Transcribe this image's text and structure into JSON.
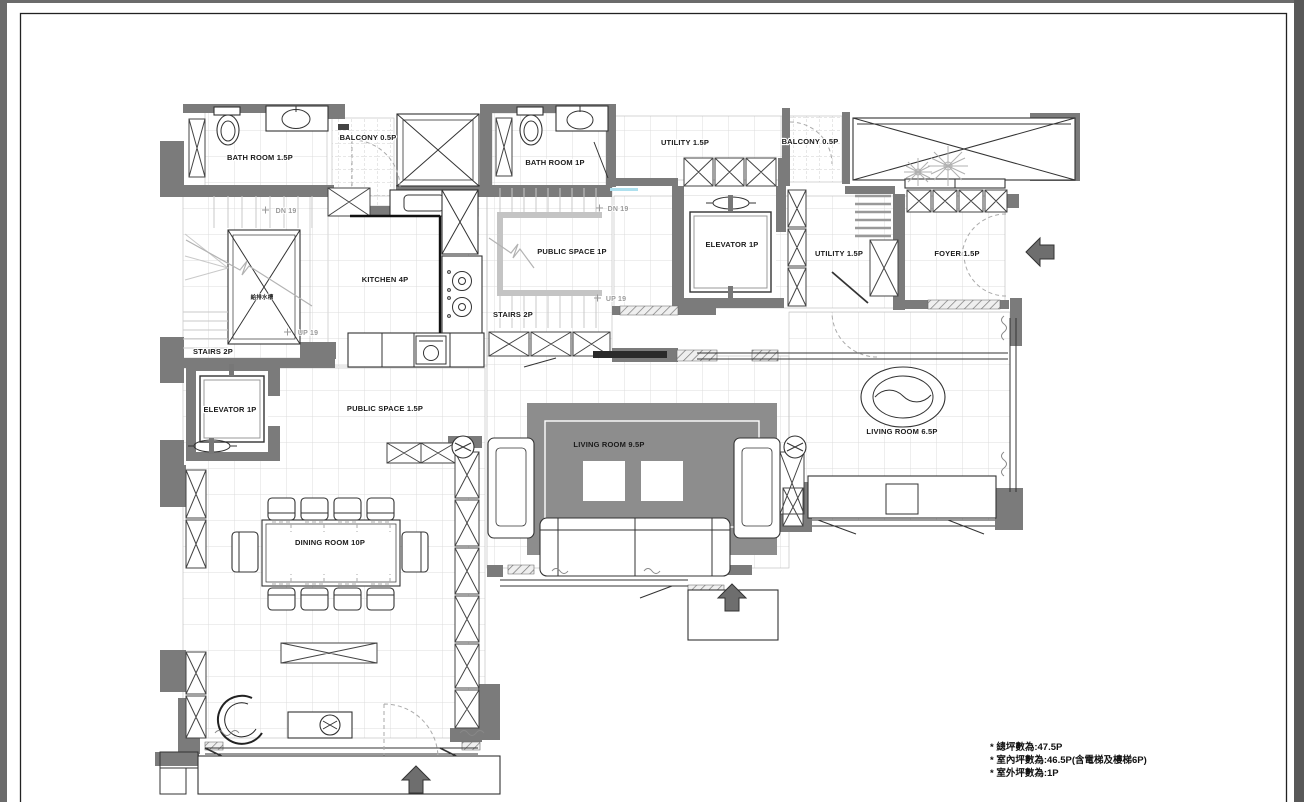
{
  "colors": {
    "wall_gray": "#7b7b7b",
    "grid_line": "#dcdcdc",
    "rug_gray": "#8d8d8d",
    "ink": "#1a1a1a",
    "muted_gray": "#9a9a9a",
    "accent_blue": "#aee0ee"
  },
  "floor_plan": {
    "rooms": {
      "bath1": "BATH ROOM 1.5P",
      "balcony1": "BALCONY 0.5P",
      "bath2": "BATH ROOM 1P",
      "utility1": "UTILITY 1.5P",
      "balcony2": "BALCONY 0.5P",
      "kitchen": "KITCHEN 4P",
      "public1": "PUBLIC SPACE 1P",
      "stairs_center": "STAIRS 2P",
      "elevator_right": "ELEVATOR 1P",
      "utility2": "UTILITY 1.5P",
      "foyer": "FOYER 1.5P",
      "stairs_left": "STAIRS 2P",
      "elevator_left": "ELEVATOR 1P",
      "public2": "PUBLIC SPACE 1.5P",
      "living_main": "LIVING ROOM 9.5P",
      "living_side": "LIVING ROOM 6.5P",
      "dining": "DINING ROOM 10P",
      "shaft_small": "給排水槽"
    },
    "stair_marks": {
      "dn_left": "DN 19",
      "up_left": "UP 19",
      "dn_center": "DN 19",
      "up_center": "UP 19"
    },
    "notes": {
      "line1": "* 總坪數為:47.5P",
      "line2": "* 室內坪數為:46.5P(含電梯及樓梯6P)",
      "line3": "* 室外坪數為:1P"
    }
  }
}
